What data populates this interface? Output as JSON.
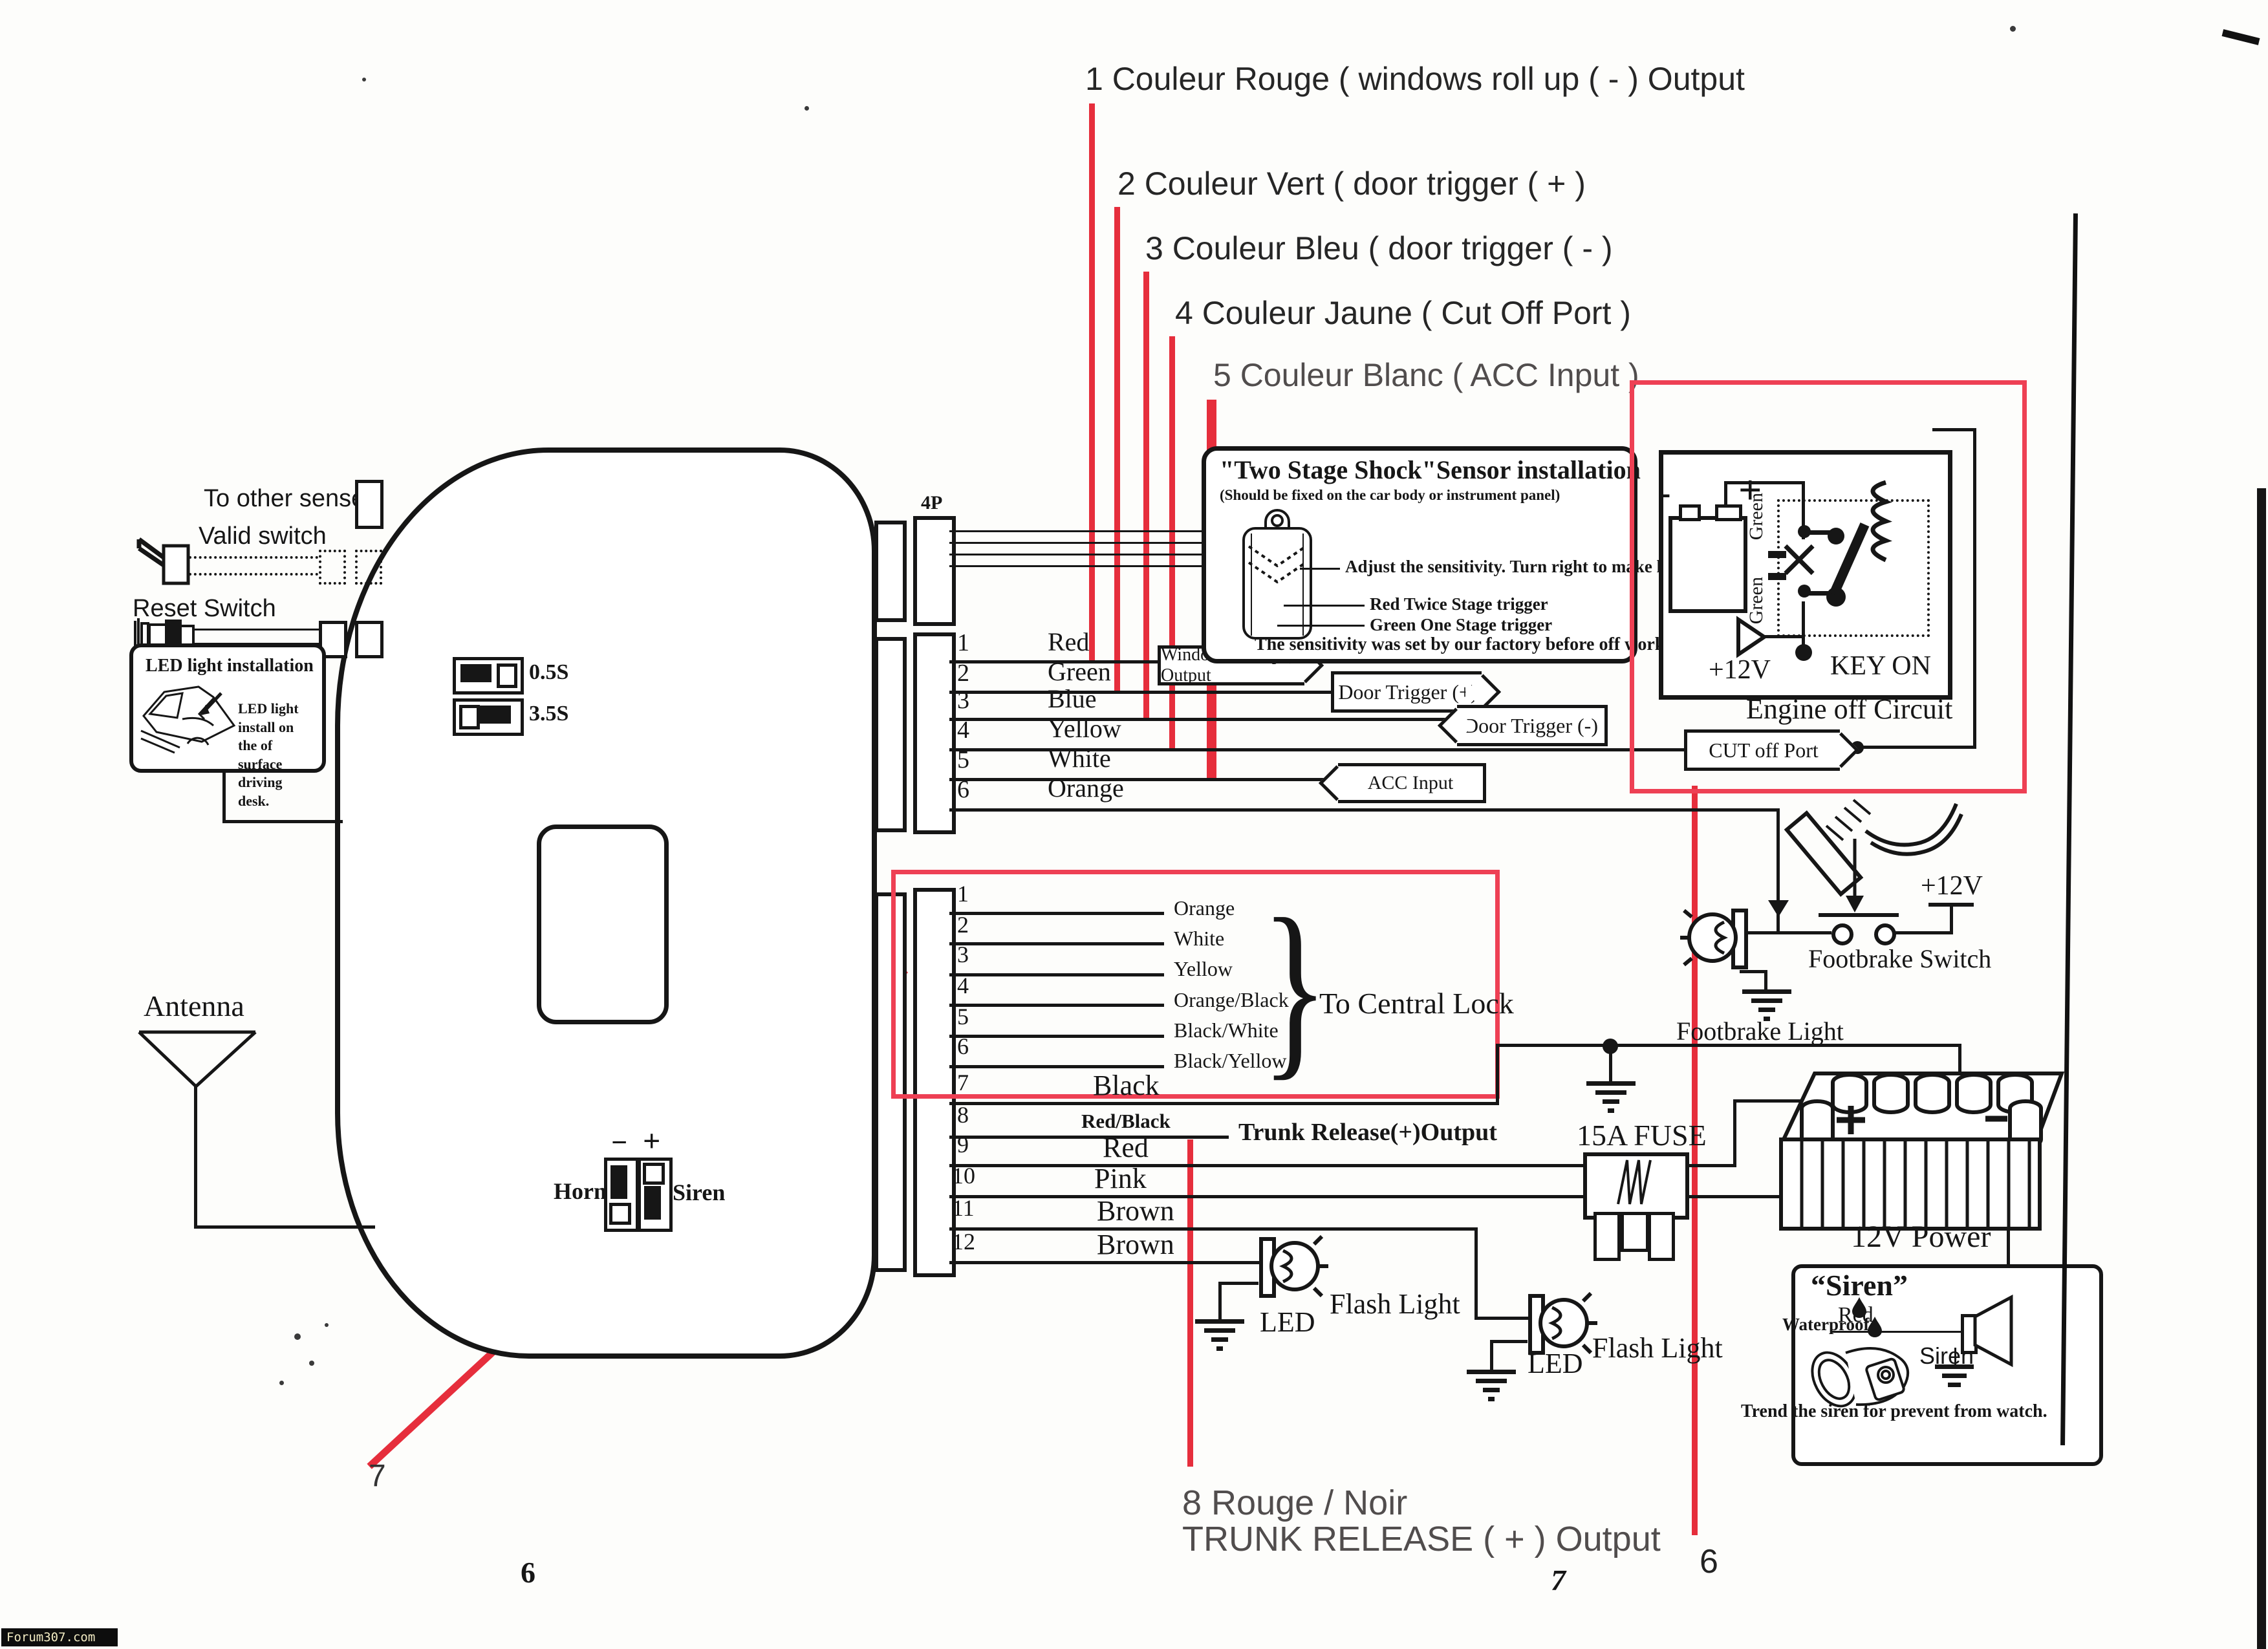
{
  "annotations": {
    "a1": "1 Couleur Rouge ( windows roll up ( - )  Output",
    "a2": "2 Couleur Vert ( door trigger ( + )",
    "a3": "3 Couleur Bleu ( door trigger ( - )",
    "a4": "4 Couleur Jaune  ( Cut Off Port )",
    "a5": "5 Couleur Blanc ( ACC Input )",
    "b8_line1": "8 Rouge / Noir",
    "b8_line2": "TRUNK RELEASE ( + ) Output",
    "marker7": "7",
    "marker6": "6"
  },
  "page_numbers": {
    "left": "6",
    "right": "7"
  },
  "left_panel": {
    "to_other_senser": "To other senser",
    "valid_switch": "Valid switch",
    "reset_switch": "Reset Switch",
    "antenna": "Antenna",
    "led_box_title": "LED light installation",
    "led_box_caption": "LED light install on the of surface driving desk."
  },
  "unit": {
    "p4": "4P",
    "dip_fast": "0.5S",
    "dip_slow": "3.5S",
    "horn": "Horn",
    "siren": "Siren",
    "minus": "−",
    "plus": "+"
  },
  "main_connector": {
    "pins": [
      {
        "n": "1",
        "color": "Red"
      },
      {
        "n": "2",
        "color": "Green"
      },
      {
        "n": "3",
        "color": "Blue"
      },
      {
        "n": "4",
        "color": "Yellow"
      },
      {
        "n": "5",
        "color": "White"
      },
      {
        "n": "6",
        "color": "Orange"
      }
    ]
  },
  "tags": {
    "window": "Window Roll up (-) Output",
    "door_pos": "Door Trigger (+)",
    "door_neg": "Door Trigger (-)",
    "acc": "ACC Input",
    "cut": "CUT off Port"
  },
  "central_lock": {
    "label": "To Central Lock",
    "pins": [
      {
        "n": "1",
        "color": "Orange"
      },
      {
        "n": "2",
        "color": "White"
      },
      {
        "n": "3",
        "color": "Yellow"
      },
      {
        "n": "4",
        "color": "Orange/Black"
      },
      {
        "n": "5",
        "color": "Black/White"
      },
      {
        "n": "6",
        "color": "Black/Yellow"
      }
    ]
  },
  "aux_pins": {
    "trunk": "Trunk Release(+)Output",
    "pins": [
      {
        "n": "7",
        "color": "Black"
      },
      {
        "n": "8",
        "color": "Red/Black"
      },
      {
        "n": "9",
        "color": "Red"
      },
      {
        "n": "10",
        "color": "Pink"
      },
      {
        "n": "11",
        "color": "Brown"
      },
      {
        "n": "12",
        "color": "Brown"
      }
    ]
  },
  "shock_box": {
    "title": "\"Two Stage Shock\"Sensor installation",
    "subtitle": "(Should be fixed on the car body or instrument panel)",
    "adjust": "Adjust the sensitivity. Turn right to make higher.",
    "red_trigger": "Red Twice Stage trigger",
    "green_trigger": "Green One Stage trigger",
    "footer": "The sensitivity was set by our factory before off work."
  },
  "engine_box": {
    "green_top": "Green",
    "green_bottom": "Green",
    "plus": "+",
    "minus": "-",
    "v12": "+12V",
    "key_on": "KEY ON",
    "caption": "Engine off Circuit"
  },
  "footbrake": {
    "switch_label": "Footbrake Switch",
    "light_label": "Footbrake Light",
    "v12": "+12V"
  },
  "power": {
    "fuse": "15A FUSE",
    "battery": "12V Power",
    "plus": "+",
    "minus": "-"
  },
  "siren_box": {
    "title": "“Siren”",
    "red": "Red",
    "waterproof": "Waterproof",
    "siren": "Siren",
    "caption": "Trend the siren for prevent from watch."
  },
  "flash1": {
    "led": "LED",
    "label": "Flash Light"
  },
  "flash2": {
    "led": "LED",
    "label": "Flash Light"
  },
  "watermark": "Forum307.com"
}
